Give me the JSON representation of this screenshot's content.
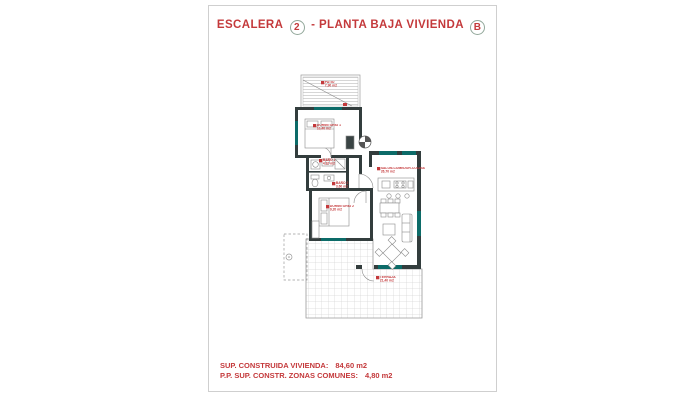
{
  "title": {
    "prefix": "ESCALERA",
    "stair_number": "2",
    "middle": "- PLANTA BAJA VIVIENDA",
    "dwelling_letter": "B"
  },
  "footer": {
    "built_area_label": "SUP. CONSTRUIDA VIVIENDA:",
    "built_area_value": "84,60 m2",
    "common_zones_label": "P.P. SUP. CONSTR. ZONAS COMUNES:",
    "common_zones_value": "4,80 m2"
  },
  "plan": {
    "rooms": [
      {
        "name": "PATIO",
        "area": "7,90 m2"
      },
      {
        "name": "DORMITORIO 1",
        "area": "10,40 m2"
      },
      {
        "name": "BAÑO 1",
        "area": "4,10 m2"
      },
      {
        "name": "BAÑO 2",
        "area": "3,60 m2"
      },
      {
        "name": "DORMITORIO 2",
        "area": "9,20 m2"
      },
      {
        "name": "SALON-COMEDOR-COCINA",
        "area": "26,70 m2"
      },
      {
        "name": "TERRAZA",
        "area": "21,40 m2"
      }
    ]
  },
  "colors": {
    "accent_red": "#c4393b",
    "wall_dark": "#333d3d",
    "window_teal": "#0c6b68",
    "page_border": "#cfcfcf"
  }
}
